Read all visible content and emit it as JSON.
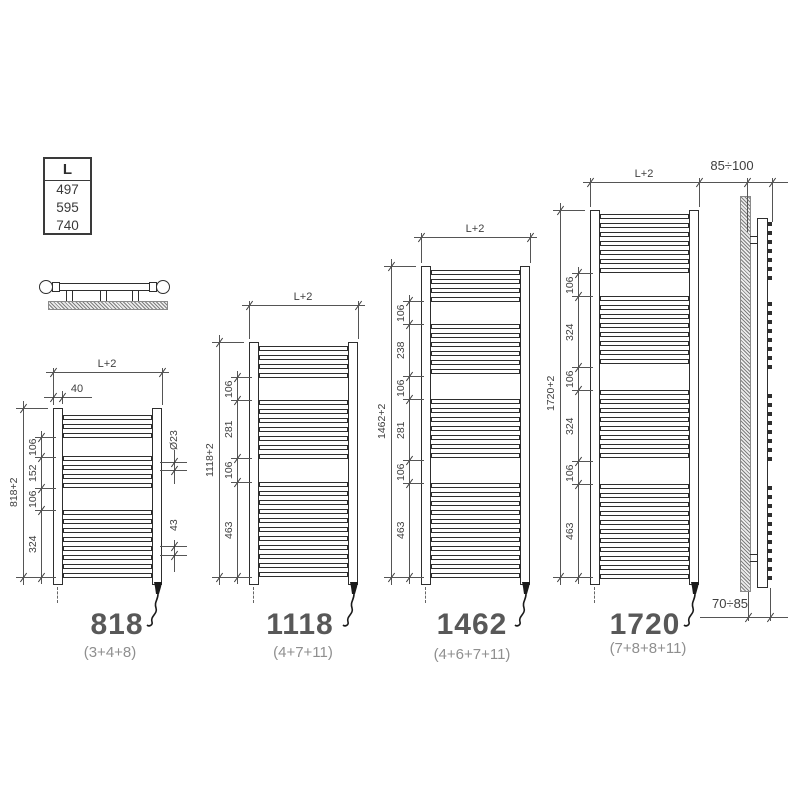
{
  "table": {
    "header": "L",
    "values": [
      "497",
      "595",
      "740"
    ]
  },
  "side_view": {
    "top_dim": "85÷100",
    "bottom_dim": "70÷85"
  },
  "models": [
    {
      "name": "818",
      "formula": "(3+4+8)",
      "overall": "818+2",
      "width_dim": "L+2",
      "offset_dim": "40",
      "diameter_dim": "Ø23",
      "pitch_dim": "43",
      "segments": [
        "106",
        "152",
        "106",
        "324"
      ],
      "groups": [
        3,
        4,
        8
      ]
    },
    {
      "name": "1118",
      "formula": "(4+7+11)",
      "overall": "1118+2",
      "width_dim": "L+2",
      "segments": [
        "106",
        "281",
        "106",
        "463"
      ],
      "groups": [
        4,
        7,
        11
      ]
    },
    {
      "name": "1462",
      "formula": "(4+6+7+11)",
      "overall": "1462+2",
      "width_dim": "L+2",
      "segments": [
        "106",
        "238",
        "106",
        "281",
        "106",
        "463"
      ],
      "groups": [
        4,
        6,
        7,
        11
      ]
    },
    {
      "name": "1720",
      "formula": "(7+8+8+11)",
      "overall": "1720+2",
      "width_dim": "L+2",
      "segments": [
        "106",
        "324",
        "106",
        "324",
        "106",
        "463"
      ],
      "groups": [
        7,
        8,
        8,
        11
      ]
    }
  ],
  "colors": {
    "line": "#555555",
    "drawing": "#2e2e2e",
    "label": "#585858",
    "formula": "#8f8f8f"
  }
}
